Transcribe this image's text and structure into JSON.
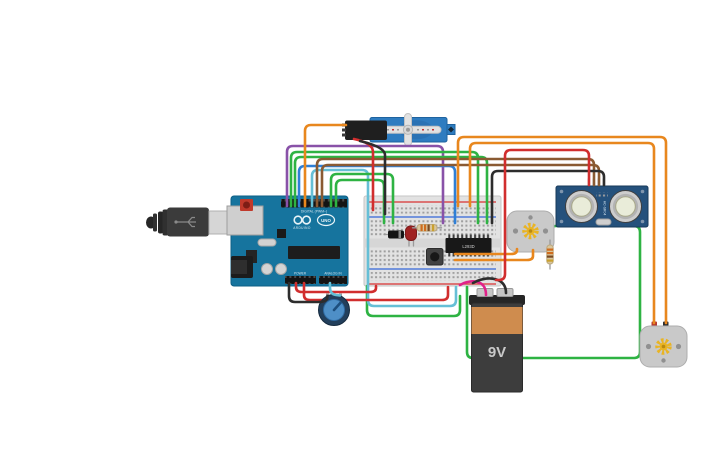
{
  "palette": {
    "background": "#ffffff",
    "wire_orange": "#e8871e",
    "wire_green": "#2eb343",
    "wire_purple": "#8952a8",
    "wire_brown": "#8a5a32",
    "wire_blue": "#2f7fd6",
    "wire_cyan": "#66bfd6",
    "wire_red": "#d12e2e",
    "wire_black": "#2d2d2d",
    "wire_magenta": "#e0218a",
    "wire_dark_red": "#b02020",
    "arduino_pcb": "#16749e",
    "breadboard_body": "#e2e2e2",
    "sensor_pcb": "#25517c",
    "servo_body": "#2e7cc0",
    "motor_body": "#c9c9c9",
    "battery_body": "#3d3d3d",
    "battery_band": "#cf8c4e",
    "pot_body": "#223f5c",
    "pot_knob": "#4e8fc7",
    "led_red": "#a02222",
    "resistor_body": "#d9c69e",
    "gear_yellow": "#e9b424"
  },
  "labels": {
    "arduino_digital": "DIGITAL (PWM~)",
    "arduino_brand": "ARDUINO",
    "arduino_model": "UNO",
    "arduino_power": "POWER",
    "arduino_analog": "ANALOG IN",
    "chip": "L293D",
    "battery": "9V",
    "sensor": "HC-SR04"
  }
}
